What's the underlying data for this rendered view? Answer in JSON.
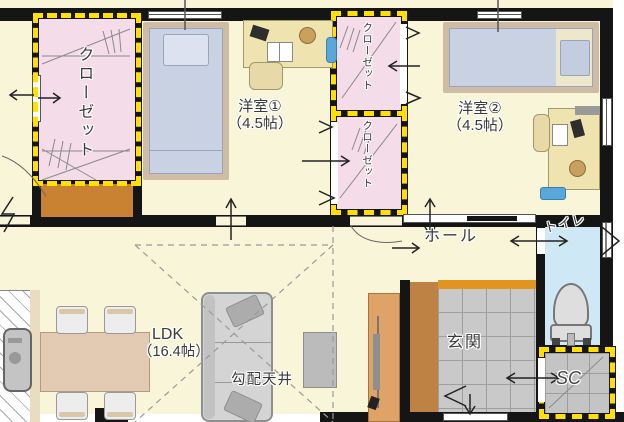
{
  "plan_type": "floor-plan",
  "rooms": {
    "closet_main": {
      "label": "クローゼット"
    },
    "bedroom1": {
      "name": "洋室①",
      "size": "（4.5帖）"
    },
    "closet_upper": {
      "label": "クローゼット"
    },
    "closet_lower": {
      "label": "クローゼット"
    },
    "bedroom2": {
      "name": "洋室②",
      "size": "（4.5帖）"
    },
    "hall": {
      "label": "ホール"
    },
    "toilet": {
      "label": "トイレ"
    },
    "entrance": {
      "label": "玄関"
    },
    "shoe_closet": {
      "label": "SC"
    },
    "ldk": {
      "name": "LDK",
      "size": "（16.4帖）"
    },
    "notes": {
      "sloped_ceiling": "勾配天井"
    }
  },
  "colors": {
    "wall": "#151515",
    "floor": "#F9F5D9",
    "closet": "#F4DCE8",
    "toilet": "#CFE8F5",
    "tile": "#C9C9C9",
    "dash": "#FFE000",
    "step": "#BE8245",
    "step_top": "#E1941F",
    "counter": "#C98231",
    "bed": "#C8D2E3",
    "desk": "#EFE3B0",
    "table": "#E2CBB2",
    "sofa": "#D4D4D4",
    "board": "#DFA368"
  }
}
